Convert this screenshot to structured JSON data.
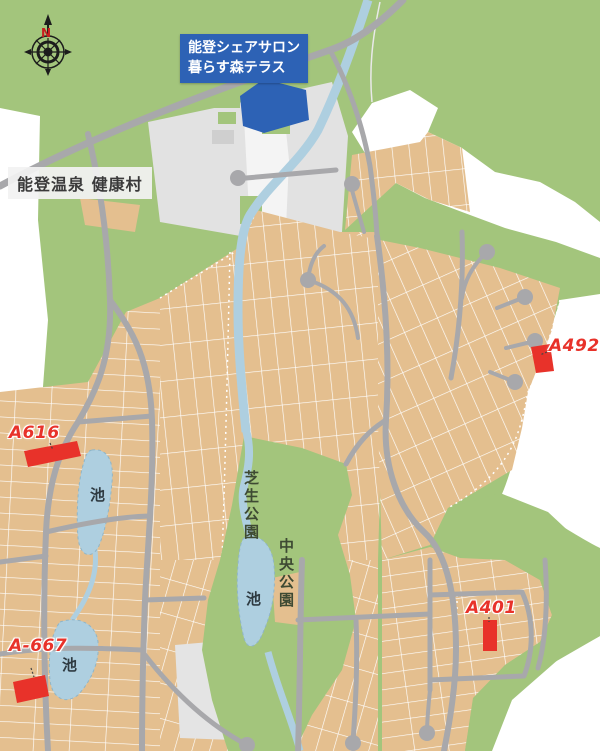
{
  "compass": {
    "north_label": "N"
  },
  "salon_callout": {
    "line1": "能登シェアサロン",
    "line2": "暮らす森テラス"
  },
  "facility_callout": {
    "label": "能登温泉 健康村"
  },
  "parks": [
    {
      "name": "芝生公園"
    },
    {
      "name": "中央公園"
    }
  ],
  "ponds": [
    {
      "label": "池"
    },
    {
      "label": "池"
    },
    {
      "label": "池"
    }
  ],
  "lots": [
    {
      "id": "A616"
    },
    {
      "id": "A492-9"
    },
    {
      "id": "A401"
    },
    {
      "id": "A-667"
    }
  ],
  "colors": {
    "forest_green": "#a3c57c",
    "lot_tan": "#e4bf8f",
    "road_gray": "#a8a8ab",
    "water_blue": "#aecfe0",
    "marker_red": "#e8322a",
    "callout_blue": "#2d62b5",
    "cleared_white": "#ffffff",
    "facility_gray": "#e2e2e2"
  }
}
